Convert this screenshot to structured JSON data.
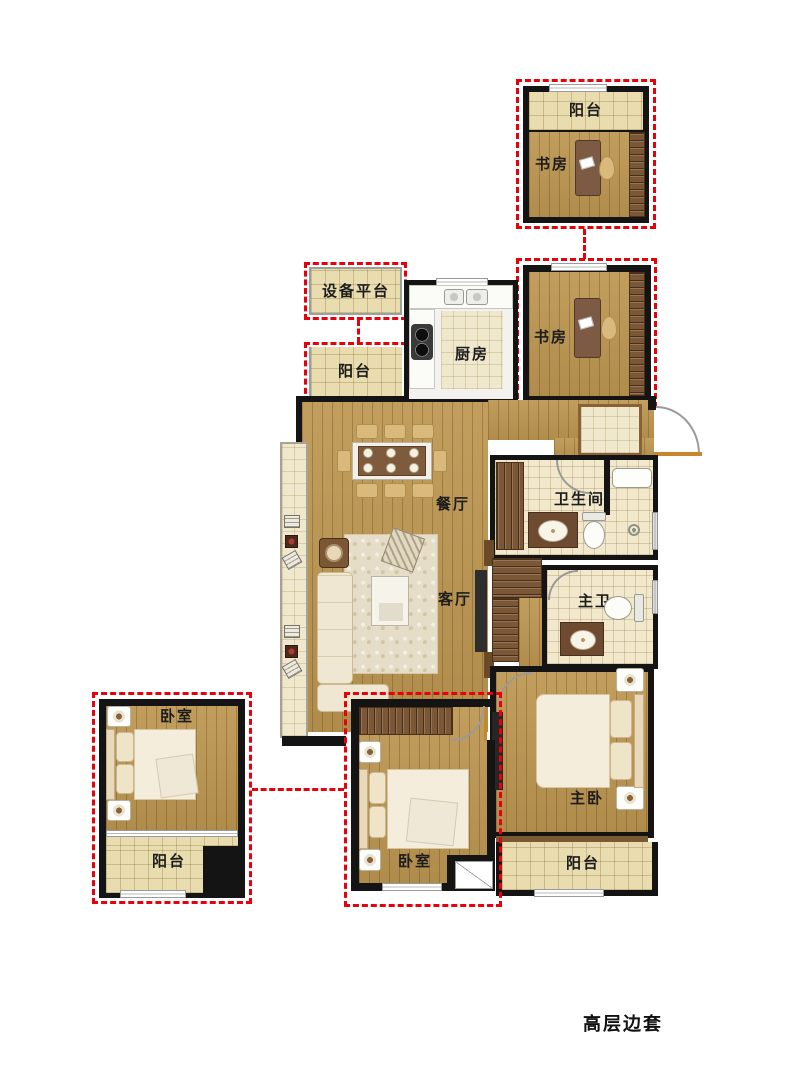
{
  "caption": "高层边套",
  "rooms": {
    "balcony_top": "阳台",
    "study_top": "书房",
    "equipment_platform": "设备平台",
    "balcony_mid": "阳台",
    "kitchen": "厨房",
    "study_mid": "书房",
    "dining": "餐厅",
    "bathroom": "卫生间",
    "living": "客厅",
    "master_bath": "主卫",
    "master_bedroom": "主卧",
    "bedroom_left": "卧室",
    "balcony_bottom_left": "阳台",
    "bedroom_mid": "卧室",
    "balcony_master": "阳台"
  },
  "colors": {
    "wall": "#141414",
    "dashed_red": "#e8000a",
    "wood": "#bd9751",
    "wood_line": "#8a6134",
    "tile": "#e9dcae",
    "tile_light": "#f0e8cc",
    "bath_tile": "#f2e9cd",
    "kitchen_floor": "#f3f2ee",
    "furniture_ivory": "#f4eddc",
    "furniture_tan": "#d9b97c",
    "cabinet_brown": "#7b5735",
    "door_orange": "#c8862e"
  }
}
